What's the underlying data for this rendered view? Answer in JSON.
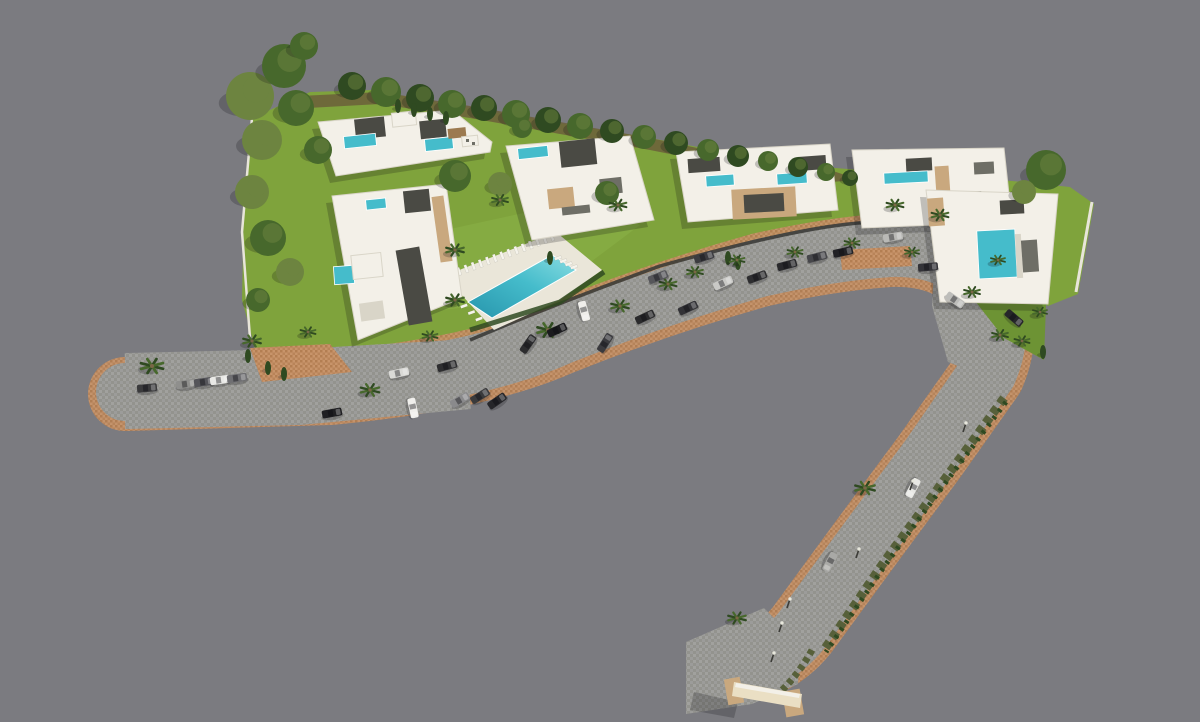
{
  "meta": {
    "description": "Aerial 3D render of a villa development site plan with road, parking, pools and landscaping. No text labels visible."
  },
  "colors": {
    "background": "#7b7b80",
    "road": "#9c9c9a",
    "road_tile": "#93938e",
    "road_tile2": "#a5a5a0",
    "paver": "#c8946a",
    "paver_dark": "#b37e52",
    "lawn": "#7fa33c",
    "lawn_dark": "#6d9334",
    "lawn_light": "#8fb54a",
    "understory": "#6b5f3a",
    "tree_dark": "#2f4a21",
    "tree_mid": "#47682c",
    "tree_olive": "#6d8440",
    "scrub": "#57603a",
    "trunk": "#7a6647",
    "white": "#f3f0e8",
    "shade": "#d9d5c8",
    "roof_dark": "#4a4a44",
    "roof_mid": "#6e6e66",
    "accent_beige": "#c9a87e",
    "accent_brown": "#9c7a50",
    "pool": "#45bccb",
    "pool_deep": "#2795ac",
    "pool_light": "#8adde2",
    "deck": "#eae6d9",
    "wall_dark": "#3c3c38",
    "wall_white": "#e8e5da",
    "gate_light": "#eadfc4",
    "lamp_head": "#e8e8dd",
    "shadow": "rgba(15,15,20,0.22)"
  },
  "scene": {
    "palms": [
      {
        "x": 152,
        "y": 366,
        "s": 1.25
      },
      {
        "x": 252,
        "y": 341,
        "s": 1
      },
      {
        "x": 308,
        "y": 332,
        "s": 0.85
      },
      {
        "x": 370,
        "y": 390,
        "s": 1.05
      },
      {
        "x": 430,
        "y": 336,
        "s": 0.85
      },
      {
        "x": 455,
        "y": 250,
        "s": 1
      },
      {
        "x": 455,
        "y": 300,
        "s": 1
      },
      {
        "x": 500,
        "y": 200,
        "s": 0.9
      },
      {
        "x": 548,
        "y": 330,
        "s": 1.2
      },
      {
        "x": 620,
        "y": 306,
        "s": 1
      },
      {
        "x": 668,
        "y": 284,
        "s": 0.95
      },
      {
        "x": 695,
        "y": 272,
        "s": 0.9
      },
      {
        "x": 737,
        "y": 260,
        "s": 0.85
      },
      {
        "x": 795,
        "y": 252,
        "s": 0.85
      },
      {
        "x": 852,
        "y": 243,
        "s": 0.85
      },
      {
        "x": 895,
        "y": 205,
        "s": 0.95
      },
      {
        "x": 940,
        "y": 215,
        "s": 0.95
      },
      {
        "x": 912,
        "y": 252,
        "s": 0.8
      },
      {
        "x": 972,
        "y": 292,
        "s": 0.9
      },
      {
        "x": 1000,
        "y": 335,
        "s": 0.9
      },
      {
        "x": 1022,
        "y": 341,
        "s": 0.85
      },
      {
        "x": 1040,
        "y": 312,
        "s": 0.8
      },
      {
        "x": 998,
        "y": 260,
        "s": 0.8
      },
      {
        "x": 865,
        "y": 488,
        "s": 1.1
      },
      {
        "x": 737,
        "y": 618,
        "s": 1
      },
      {
        "x": 618,
        "y": 205,
        "s": 0.95
      }
    ],
    "trees": [
      {
        "x": 250,
        "y": 96,
        "r": 24,
        "c": "tree_olive"
      },
      {
        "x": 284,
        "y": 66,
        "r": 22,
        "c": "tree_mid"
      },
      {
        "x": 304,
        "y": 46,
        "r": 14,
        "c": "tree_mid"
      },
      {
        "x": 262,
        "y": 140,
        "r": 20,
        "c": "tree_olive"
      },
      {
        "x": 296,
        "y": 108,
        "r": 18,
        "c": "tree_mid"
      },
      {
        "x": 318,
        "y": 150,
        "r": 14,
        "c": "tree_mid"
      },
      {
        "x": 252,
        "y": 192,
        "r": 17,
        "c": "tree_olive"
      },
      {
        "x": 268,
        "y": 238,
        "r": 18,
        "c": "tree_mid"
      },
      {
        "x": 290,
        "y": 272,
        "r": 14,
        "c": "tree_olive"
      },
      {
        "x": 258,
        "y": 300,
        "r": 12,
        "c": "tree_mid"
      },
      {
        "x": 352,
        "y": 86,
        "r": 14,
        "c": "tree_dark"
      },
      {
        "x": 386,
        "y": 92,
        "r": 15,
        "c": "tree_mid"
      },
      {
        "x": 420,
        "y": 98,
        "r": 14,
        "c": "tree_dark"
      },
      {
        "x": 452,
        "y": 104,
        "r": 14,
        "c": "tree_mid"
      },
      {
        "x": 484,
        "y": 108,
        "r": 13,
        "c": "tree_dark"
      },
      {
        "x": 516,
        "y": 114,
        "r": 14,
        "c": "tree_mid"
      },
      {
        "x": 548,
        "y": 120,
        "r": 13,
        "c": "tree_dark"
      },
      {
        "x": 580,
        "y": 126,
        "r": 13,
        "c": "tree_mid"
      },
      {
        "x": 612,
        "y": 131,
        "r": 12,
        "c": "tree_dark"
      },
      {
        "x": 644,
        "y": 137,
        "r": 12,
        "c": "tree_mid"
      },
      {
        "x": 676,
        "y": 143,
        "r": 12,
        "c": "tree_dark"
      },
      {
        "x": 708,
        "y": 150,
        "r": 11,
        "c": "tree_mid"
      },
      {
        "x": 738,
        "y": 156,
        "r": 11,
        "c": "tree_dark"
      },
      {
        "x": 768,
        "y": 161,
        "r": 10,
        "c": "tree_mid"
      },
      {
        "x": 798,
        "y": 167,
        "r": 10,
        "c": "tree_dark"
      },
      {
        "x": 826,
        "y": 172,
        "r": 9,
        "c": "tree_mid"
      },
      {
        "x": 850,
        "y": 178,
        "r": 8,
        "c": "tree_dark"
      },
      {
        "x": 455,
        "y": 176,
        "r": 16,
        "c": "tree_mid"
      },
      {
        "x": 500,
        "y": 184,
        "r": 12,
        "c": "tree_olive"
      },
      {
        "x": 522,
        "y": 128,
        "r": 10,
        "c": "tree_mid"
      },
      {
        "x": 607,
        "y": 193,
        "r": 12,
        "c": "tree_mid"
      },
      {
        "x": 1046,
        "y": 170,
        "r": 20,
        "c": "tree_mid"
      },
      {
        "x": 1024,
        "y": 192,
        "r": 12,
        "c": "tree_olive"
      }
    ],
    "cypresses": [
      {
        "x": 248,
        "y": 356
      },
      {
        "x": 268,
        "y": 368
      },
      {
        "x": 284,
        "y": 374
      },
      {
        "x": 398,
        "y": 106
      },
      {
        "x": 414,
        "y": 110
      },
      {
        "x": 430,
        "y": 114
      },
      {
        "x": 446,
        "y": 118
      },
      {
        "x": 728,
        "y": 258
      },
      {
        "x": 738,
        "y": 263
      },
      {
        "x": 1043,
        "y": 352
      },
      {
        "x": 550,
        "y": 258
      }
    ],
    "cars": [
      {
        "x": 147,
        "y": 388,
        "r": -5,
        "c": "#3a3a3c"
      },
      {
        "x": 186,
        "y": 384,
        "r": -8,
        "c": "#8f8f8d"
      },
      {
        "x": 204,
        "y": 382,
        "r": -8,
        "c": "#55555a"
      },
      {
        "x": 220,
        "y": 380,
        "r": -8,
        "c": "#e9e9e6"
      },
      {
        "x": 237,
        "y": 378,
        "r": -8,
        "c": "#6f6f72"
      },
      {
        "x": 399,
        "y": 373,
        "r": -12,
        "c": "#d9d9d6"
      },
      {
        "x": 447,
        "y": 366,
        "r": -15,
        "c": "#2e2e30"
      },
      {
        "x": 460,
        "y": 400,
        "r": -30,
        "c": "#8a8a8c"
      },
      {
        "x": 480,
        "y": 396,
        "r": -32,
        "c": "#3a3a3c"
      },
      {
        "x": 497,
        "y": 401,
        "r": -35,
        "c": "#26262a"
      },
      {
        "x": 332,
        "y": 413,
        "r": -10,
        "c": "#1f1f22"
      },
      {
        "x": 413,
        "y": 408,
        "r": 78,
        "c": "#f0efec"
      },
      {
        "x": 528,
        "y": 344,
        "r": -55,
        "c": "#2c2c2e"
      },
      {
        "x": 605,
        "y": 343,
        "r": -58,
        "c": "#3a3a3e"
      },
      {
        "x": 584,
        "y": 311,
        "r": 75,
        "c": "#efeeea"
      },
      {
        "x": 557,
        "y": 330,
        "r": -25,
        "c": "#1b1b1e"
      },
      {
        "x": 645,
        "y": 317,
        "r": -25,
        "c": "#2a2a2c"
      },
      {
        "x": 688,
        "y": 308,
        "r": -25,
        "c": "#323236"
      },
      {
        "x": 723,
        "y": 283,
        "r": -25,
        "c": "#c9c9c6"
      },
      {
        "x": 658,
        "y": 277,
        "r": -22,
        "c": "#56565a"
      },
      {
        "x": 757,
        "y": 277,
        "r": -20,
        "c": "#2e2e30"
      },
      {
        "x": 704,
        "y": 257,
        "r": -18,
        "c": "#3c3c40"
      },
      {
        "x": 787,
        "y": 265,
        "r": -15,
        "c": "#29292c"
      },
      {
        "x": 817,
        "y": 257,
        "r": -14,
        "c": "#46464a"
      },
      {
        "x": 843,
        "y": 252,
        "r": -12,
        "c": "#222226"
      },
      {
        "x": 893,
        "y": 237,
        "r": -10,
        "c": "#b9b9b6"
      },
      {
        "x": 928,
        "y": 267,
        "r": -5,
        "c": "#333338"
      },
      {
        "x": 955,
        "y": 300,
        "r": 35,
        "c": "#bdbdba"
      },
      {
        "x": 1014,
        "y": 318,
        "r": 40,
        "c": "#26262a"
      },
      {
        "x": 913,
        "y": 488,
        "r": 118,
        "c": "#e8e8e4"
      },
      {
        "x": 830,
        "y": 562,
        "r": 118,
        "c": "#a9a9a6"
      }
    ],
    "lamps": [
      {
        "x": 963,
        "y": 432
      },
      {
        "x": 910,
        "y": 490
      },
      {
        "x": 856,
        "y": 558
      },
      {
        "x": 787,
        "y": 608
      },
      {
        "x": 779,
        "y": 632
      },
      {
        "x": 771,
        "y": 662
      }
    ],
    "lounger_rows": [
      {
        "x1": 452,
        "y1": 274,
        "x2": 552,
        "y2": 237,
        "n": 15,
        "len": 8,
        "ang": 70
      },
      {
        "x1": 558,
        "y1": 258,
        "x2": 574,
        "y2": 267,
        "n": 4,
        "len": 7,
        "ang": -20
      },
      {
        "x1": 464,
        "y1": 306,
        "x2": 479,
        "y2": 319,
        "n": 3,
        "len": 7,
        "ang": -20
      }
    ],
    "buildings": [
      {
        "name": "villa-block-northwest",
        "base": "318,122 452,110 492,142 490,152 336,176",
        "parts": [
          {
            "x": 355,
            "y": 118,
            "w": 30,
            "h": 20,
            "f": "roof_dark",
            "r": -6
          },
          {
            "x": 420,
            "y": 120,
            "w": 26,
            "h": 18,
            "f": "roof_dark",
            "r": -6
          },
          {
            "x": 392,
            "y": 112,
            "w": 24,
            "h": 14,
            "f": "white",
            "r": -6
          },
          {
            "x": 344,
            "y": 135,
            "w": 32,
            "h": 12,
            "f": "pool",
            "r": -6
          },
          {
            "x": 425,
            "y": 138,
            "w": 28,
            "h": 12,
            "f": "pool",
            "r": -6
          },
          {
            "x": 448,
            "y": 128,
            "w": 18,
            "h": 10,
            "f": "accent_brown",
            "r": -6
          },
          {
            "x": 462,
            "y": 136,
            "w": 16,
            "h": 10,
            "f": "white",
            "r": -6
          },
          {
            "x": 466,
            "y": 139,
            "w": 3,
            "h": 3,
            "f": "roof_mid",
            "r": 0
          },
          {
            "x": 472,
            "y": 142,
            "w": 3,
            "h": 3,
            "f": "roof_mid",
            "r": 0
          }
        ]
      },
      {
        "name": "apartment-block-west",
        "base": "332,196 446,184 462,298 358,340",
        "parts": [
          {
            "x": 366,
            "y": 199,
            "w": 20,
            "h": 10,
            "f": "pool",
            "r": -6
          },
          {
            "x": 404,
            "y": 190,
            "w": 26,
            "h": 22,
            "f": "roof_dark",
            "r": -6
          },
          {
            "x": 436,
            "y": 196,
            "w": 12,
            "h": 66,
            "f": "accent_beige",
            "r": -8
          },
          {
            "x": 402,
            "y": 248,
            "w": 24,
            "h": 76,
            "f": "roof_dark",
            "r": -10
          },
          {
            "x": 334,
            "y": 266,
            "w": 20,
            "h": 18,
            "f": "pool",
            "r": -4
          },
          {
            "x": 352,
            "y": 254,
            "w": 30,
            "h": 24,
            "f": "white",
            "r": -6
          },
          {
            "x": 360,
            "y": 302,
            "w": 24,
            "h": 18,
            "f": "shade",
            "r": -8
          }
        ]
      },
      {
        "name": "villa-central",
        "base": "506,146 630,136 654,220 532,240",
        "parts": [
          {
            "x": 518,
            "y": 147,
            "w": 30,
            "h": 11,
            "f": "pool",
            "r": -6
          },
          {
            "x": 560,
            "y": 140,
            "w": 36,
            "h": 26,
            "f": "roof_dark",
            "r": -6
          },
          {
            "x": 600,
            "y": 178,
            "w": 22,
            "h": 16,
            "f": "roof_mid",
            "r": -6
          },
          {
            "x": 548,
            "y": 188,
            "w": 26,
            "h": 20,
            "f": "accent_beige",
            "r": -6
          },
          {
            "x": 562,
            "y": 206,
            "w": 28,
            "h": 8,
            "f": "roof_mid",
            "r": -6
          }
        ]
      },
      {
        "name": "villa-mid-east",
        "base": "676,152 830,144 838,210 688,222",
        "parts": [
          {
            "x": 688,
            "y": 158,
            "w": 32,
            "h": 14,
            "f": "roof_dark",
            "r": -4
          },
          {
            "x": 798,
            "y": 156,
            "w": 28,
            "h": 14,
            "f": "roof_dark",
            "r": -4
          },
          {
            "x": 706,
            "y": 175,
            "w": 28,
            "h": 11,
            "f": "pool",
            "r": -4
          },
          {
            "x": 777,
            "y": 173,
            "w": 30,
            "h": 11,
            "f": "pool",
            "r": -4
          },
          {
            "x": 732,
            "y": 188,
            "w": 64,
            "h": 30,
            "f": "accent_beige",
            "r": -3
          },
          {
            "x": 744,
            "y": 194,
            "w": 40,
            "h": 18,
            "f": "roof_dark",
            "r": -3
          }
        ]
      },
      {
        "name": "villa-east",
        "base": "852,150 1004,148 1012,222 862,228",
        "parts": [
          {
            "x": 906,
            "y": 158,
            "w": 26,
            "h": 13,
            "f": "roof_dark",
            "r": -3
          },
          {
            "x": 974,
            "y": 162,
            "w": 20,
            "h": 12,
            "f": "roof_mid",
            "r": -3
          },
          {
            "x": 884,
            "y": 172,
            "w": 44,
            "h": 11,
            "f": "pool",
            "r": -3
          },
          {
            "x": 936,
            "y": 166,
            "w": 14,
            "h": 44,
            "f": "accent_beige",
            "r": -4
          },
          {
            "x": 952,
            "y": 192,
            "w": 30,
            "h": 22,
            "f": "roof_dark",
            "r": -4
          }
        ]
      },
      {
        "name": "villa-southeast-corner",
        "base": "926,190 1058,194 1048,304 940,302",
        "parts": [
          {
            "x": 928,
            "y": 198,
            "w": 16,
            "h": 28,
            "f": "accent_beige",
            "r": -4
          },
          {
            "x": 1000,
            "y": 200,
            "w": 24,
            "h": 14,
            "f": "roof_dark",
            "r": -3
          },
          {
            "x": 978,
            "y": 230,
            "w": 38,
            "h": 48,
            "f": "pool",
            "r": -3
          },
          {
            "x": 1016,
            "y": 234,
            "w": 6,
            "h": 44,
            "f": "shade",
            "r": -3
          },
          {
            "x": 1022,
            "y": 240,
            "w": 16,
            "h": 32,
            "f": "roof_mid",
            "r": -4
          }
        ]
      }
    ]
  }
}
